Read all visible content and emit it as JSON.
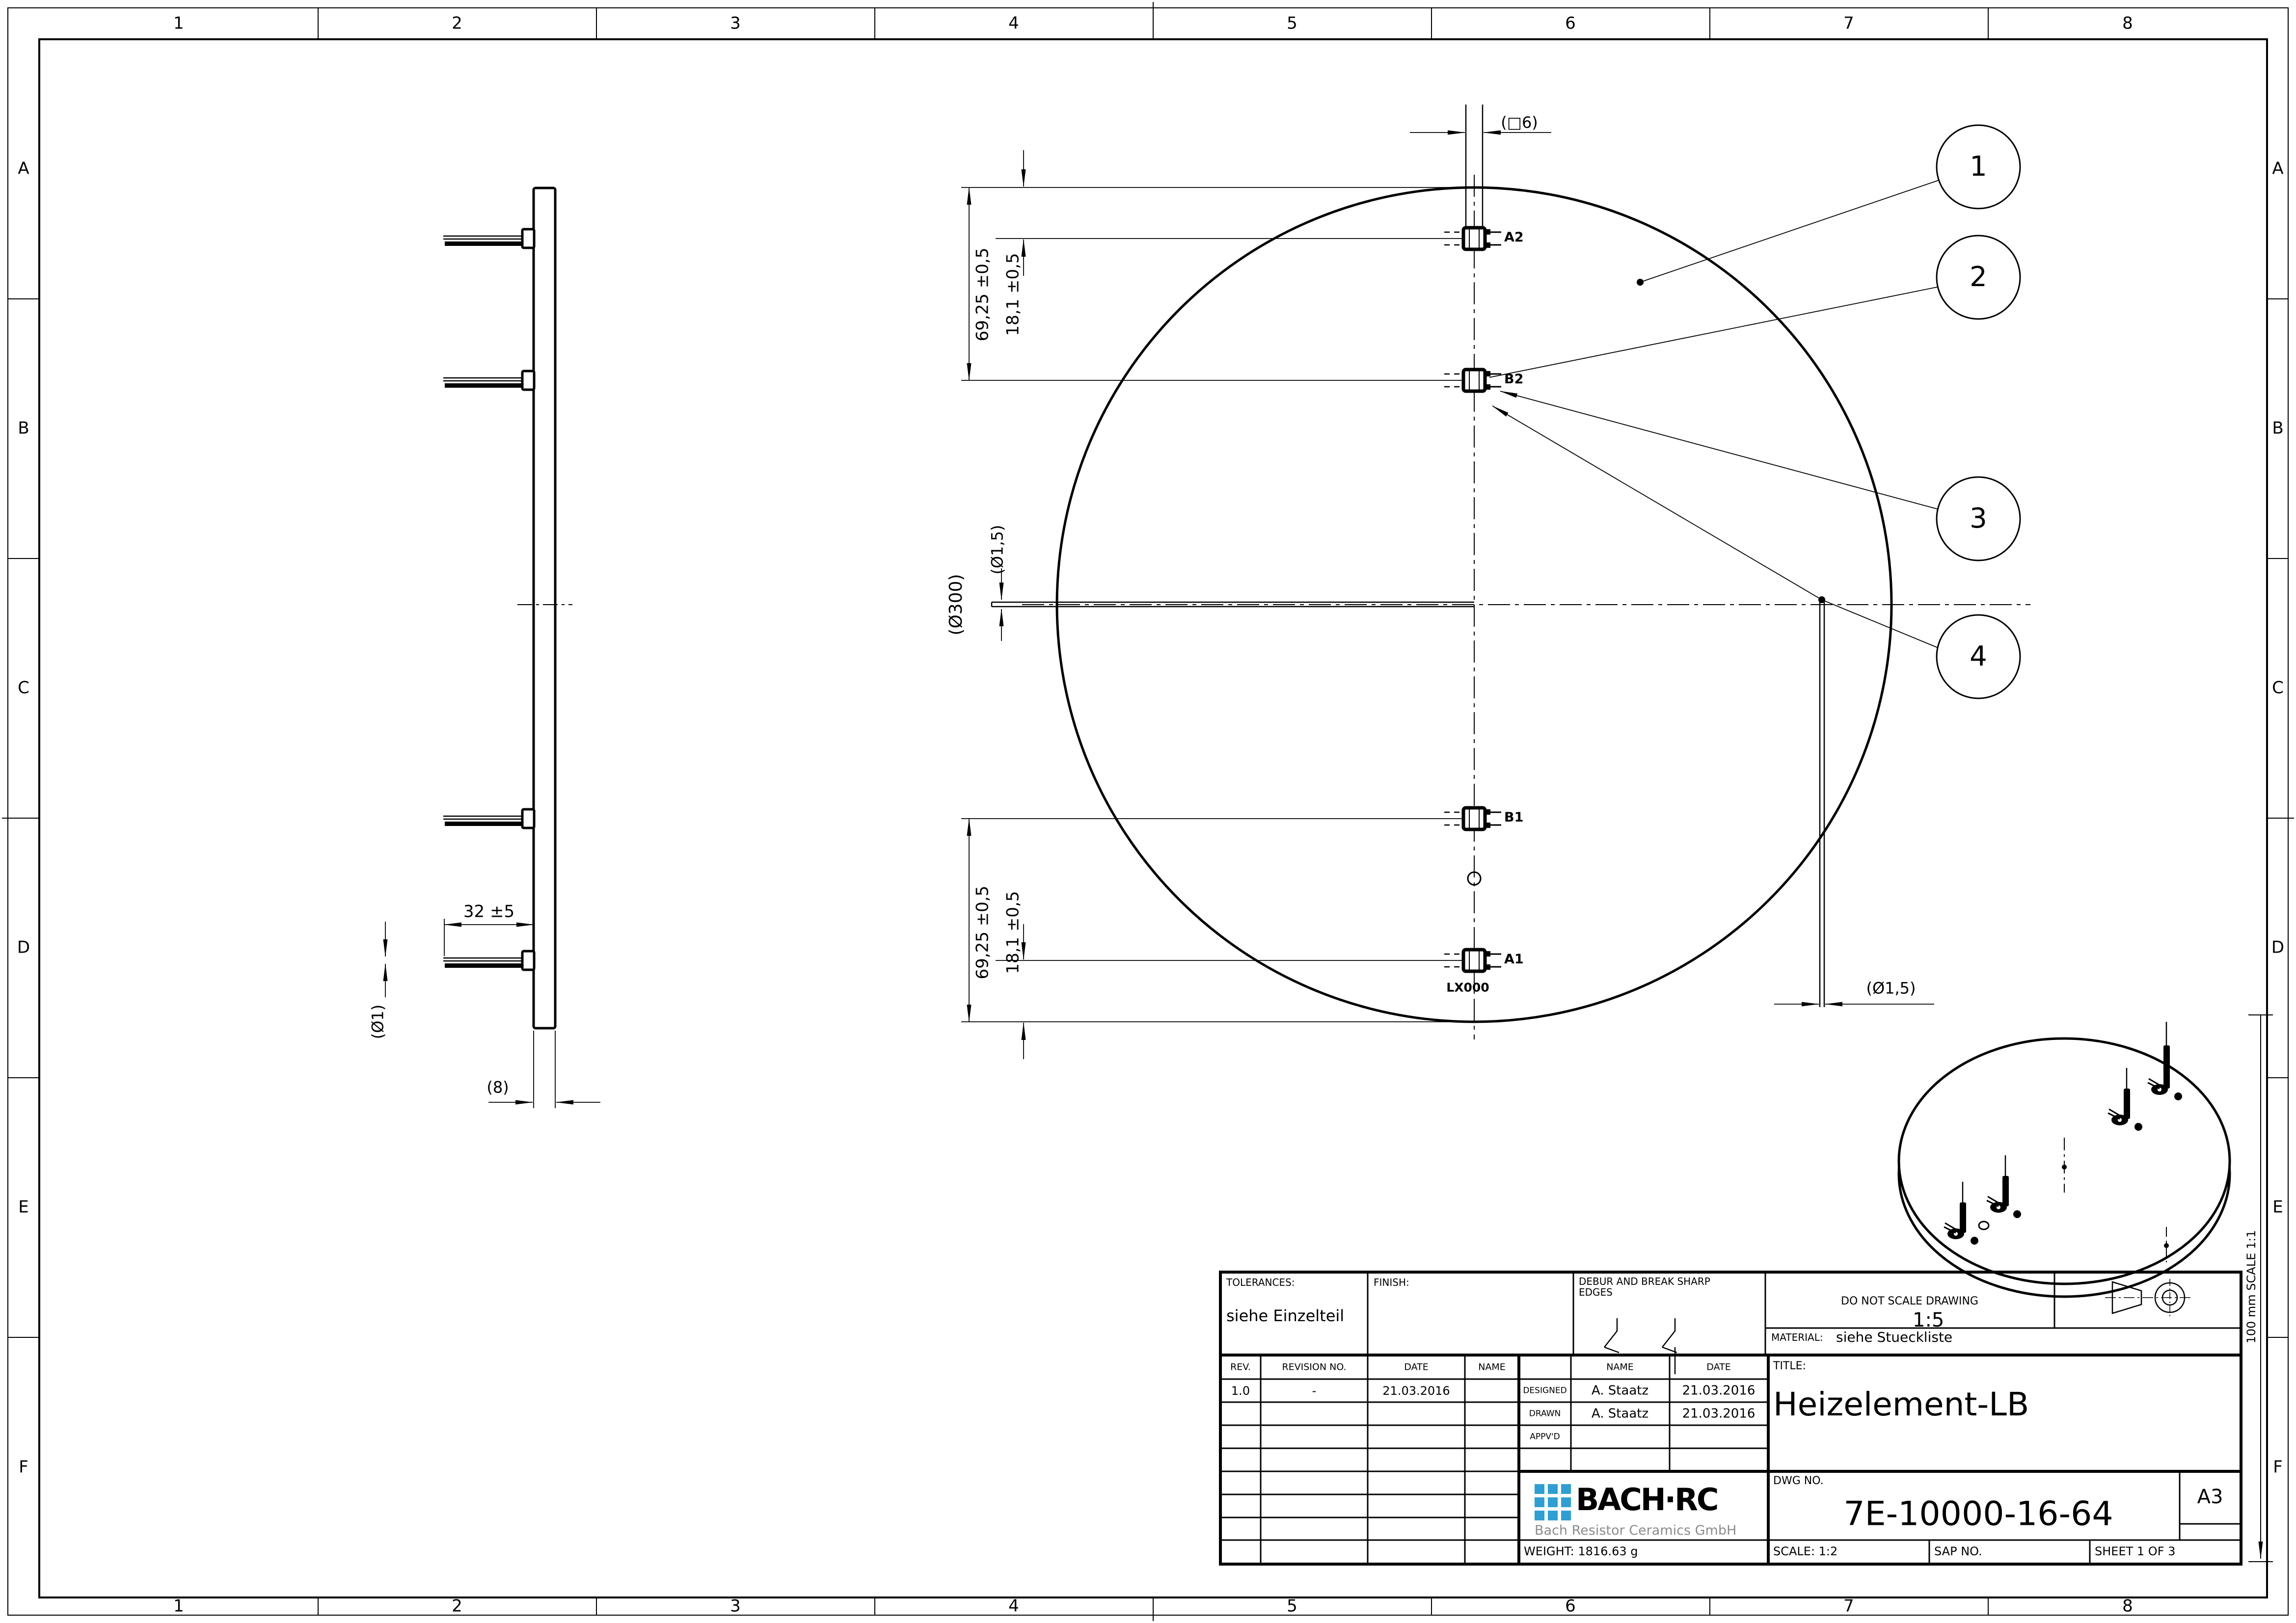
{
  "sheet": {
    "zones_h": [
      "1",
      "2",
      "3",
      "4",
      "5",
      "6",
      "7",
      "8"
    ],
    "zones_v": [
      "A",
      "B",
      "C",
      "D",
      "E",
      "F"
    ],
    "scale_ruler": "100 mm SCALE 1:1"
  },
  "front": {
    "dim_square6": "(□6)",
    "dim_69_top": "69,25 ±0,5",
    "dim_18_top": "18,1 ±0,5",
    "dim_69_bottom": "69,25 ±0,5",
    "dim_18_bottom": "18,1 ±0,5",
    "dim_d300": "(Ø300)",
    "dim_d15_left": "(Ø1,5)",
    "dim_d15_right": "(Ø1,5)",
    "marking": "LX000",
    "terminals": [
      {
        "label": "A2"
      },
      {
        "label": "B2"
      },
      {
        "label": "B1"
      },
      {
        "label": "A1"
      }
    ],
    "balloons": [
      {
        "n": "1"
      },
      {
        "n": "2"
      },
      {
        "n": "3"
      },
      {
        "n": "4"
      }
    ]
  },
  "side": {
    "dim_32": "32 ±5",
    "dim_d1": "(Ø1)",
    "dim_8": "(8)"
  },
  "iso": {
    "scale_label": "1:5"
  },
  "title_block": {
    "tolerances_label": "TOLERANCES:",
    "tolerances_value": "siehe Einzelteil",
    "finish_label": "FINISH:",
    "debur_label": "DEBUR AND BREAK SHARP EDGES",
    "do_not_scale": "DO NOT SCALE DRAWING",
    "material_label": "MATERIAL:",
    "material_value": "siehe Stueckliste",
    "rev_table": {
      "headers": [
        "REV.",
        "REVISION NO.",
        "DATE",
        "NAME"
      ],
      "row": [
        "1.0",
        "-",
        "21.03.2016"
      ]
    },
    "sign_table": {
      "name_header": "NAME",
      "date_header": "DATE",
      "designed_label": "DESIGNED",
      "drawn_label": "DRAWN",
      "approved_label": "APPV'D",
      "designed_name": "A. Staatz",
      "designed_date": "21.03.2016",
      "drawn_name": "A. Staatz",
      "drawn_date": "21.03.2016"
    },
    "title_label": "TITLE:",
    "title": "Heizelement-LB",
    "dwg_label": "DWG NO.",
    "dwg_no": "7E-10000-16-64",
    "paper_size": "A3",
    "weight": "WEIGHT: 1816.63 g",
    "scale": "SCALE: 1:2",
    "sap": "SAP NO.",
    "sheet_no": "SHEET 1 OF 3",
    "logo_text": "BACH·RC",
    "logo_sub": "Bach Resistor Ceramics GmbH",
    "colors": {
      "logo_blue": "#2e9fd4",
      "logo_gray": "#8c8c8c",
      "line": "#000000"
    }
  }
}
